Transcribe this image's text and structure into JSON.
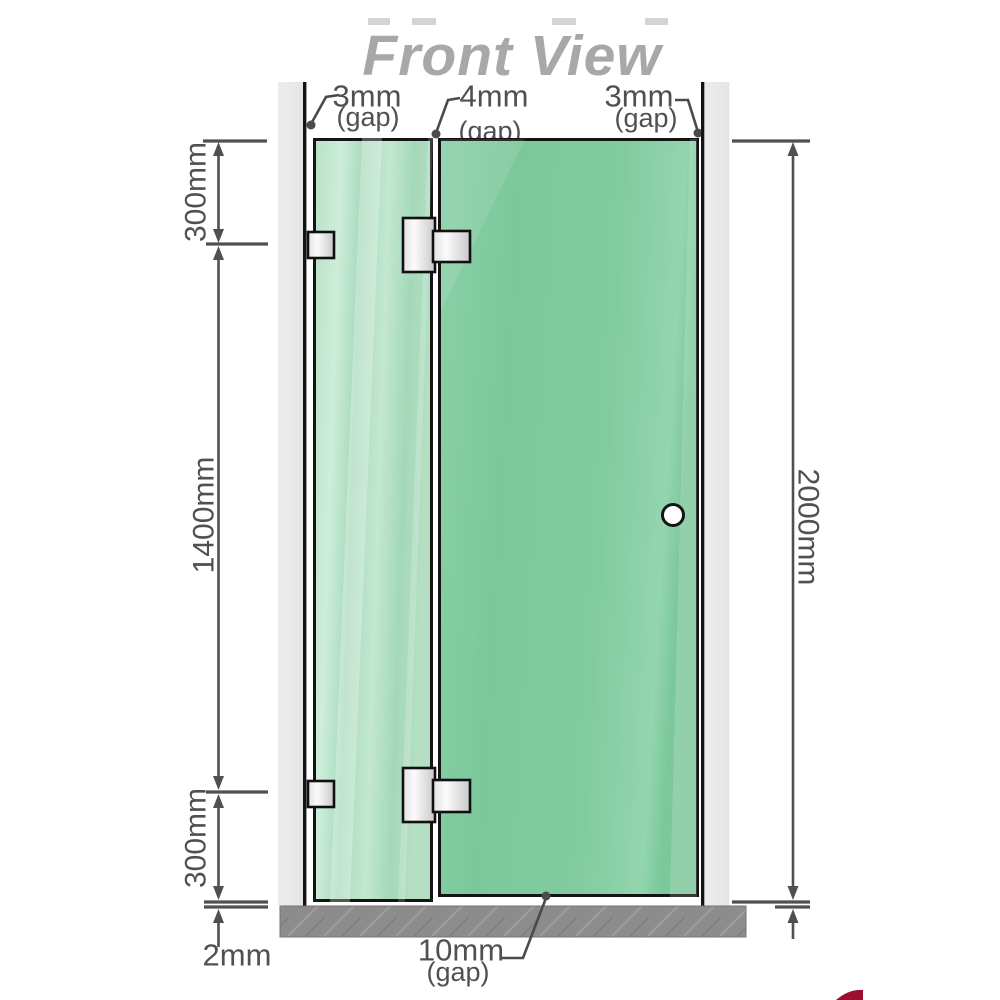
{
  "title": "Front View",
  "dims": {
    "gap_left": {
      "value": "3mm",
      "suffix": "(gap)"
    },
    "gap_middle": {
      "value": "4mm",
      "suffix": "(gap)"
    },
    "gap_right": {
      "value": "3mm",
      "suffix": "(gap)"
    },
    "gap_bottom": {
      "value": "10mm",
      "suffix": "(gap)"
    },
    "seg_top": "300mm",
    "seg_mid": "1400mm",
    "seg_bottom": "300mm",
    "floor_clearance": "2mm",
    "total_height": "2000mm"
  },
  "colors": {
    "title_text": "#a8a8a8",
    "dimension_ink": "#4f5052",
    "wall": "#e9eae9",
    "floor_base": "#8c8c8c",
    "glass_fixed_panel": "#aedec1",
    "glass_door_panel": "#7fc99e",
    "hinge_silver": "#e9e9e9",
    "outline_black": "#141414",
    "logo_accent": "#9e0f2e"
  }
}
